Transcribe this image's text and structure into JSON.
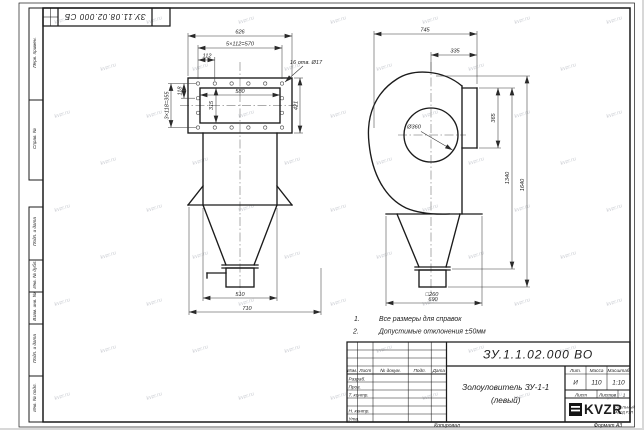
{
  "corner_stamp": {
    "doc_number": "ЗУ.11.08.02.000 СБ"
  },
  "margin_labels": [
    "Перв. примен.",
    "Справ. №",
    "Подп. и дата",
    "Инв. № дубл.",
    "Взам. инв. №",
    "Подп. и дата",
    "Инв. № подл."
  ],
  "front_view": {
    "dim_width": "626",
    "dim_hole_span": "5×112=570",
    "dim_hole_pitch": "112",
    "holes_note": "16 отв. Ø17",
    "dim_side_pitch": "118",
    "dim_side_span": "3×118=355",
    "dim_opening_w": "580",
    "dim_opening_h": "315",
    "dim_flange_h": "421",
    "dim_outlet": "510",
    "dim_base": "710"
  },
  "side_view": {
    "dim_width": "745",
    "dim_inlet": "335",
    "dim_flange_h": "365",
    "dim_diameter": "Ø360",
    "dim_h_flange": "1340",
    "dim_h_total": "1640",
    "dim_outlet": "□260",
    "dim_base": "690"
  },
  "notes": [
    {
      "num": "1.",
      "text": "Все размеры для справок"
    },
    {
      "num": "2.",
      "text": "Допустимые отклонения ±50мм"
    }
  ],
  "title_block": {
    "doc_number": "ЗУ.1.1.02.000 ВО",
    "product_line1": "Золоуловитель ЗУ-1-1",
    "product_line2": "(левый)",
    "header_cells": [
      "Изм.",
      "Лист",
      "№ докум.",
      "Подп.",
      "Дата"
    ],
    "row_labels": [
      "Разраб.",
      "Пров.",
      "Т. контр.",
      "Н. контр.",
      "Утв."
    ],
    "lit_label": "Лит.",
    "mass_label": "Масса",
    "scale_label": "Масштаб",
    "lit_value": "И",
    "mass_value": "110",
    "scale_value": "1:10",
    "sheet_label": "Лист",
    "sheets_label": "Листов",
    "sheets_value": "1",
    "logo_text": "KVZR",
    "logo_tagline_1": "КОТЕЛЬНЫЙ",
    "logo_tagline_2": "ЗАВОД РЭП"
  },
  "footer": {
    "copied": "Копировал",
    "format": "Формат А3"
  },
  "watermark": {
    "text": "kvzr.ru"
  }
}
